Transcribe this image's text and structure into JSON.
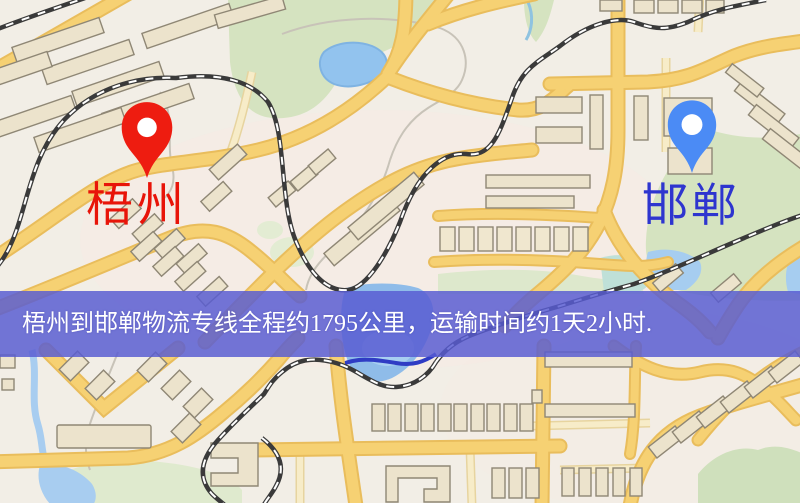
{
  "map": {
    "markers": {
      "origin": {
        "label": "梧州",
        "pin_color": "#ee1c10",
        "label_color": "#e81409"
      },
      "destination": {
        "label": "邯郸",
        "pin_color": "#4b8bf5",
        "label_color": "#2e35cf"
      }
    },
    "banner": {
      "text": "梧州到邯郸物流专线全程约1795公里，运输时间约1天2小时.",
      "background_color": "#585cd2",
      "text_color": "#ffffff"
    },
    "palette": {
      "background": "#f2eee6",
      "road": "#f6d173",
      "road_casing": "#e9bd5c",
      "road_minor": "#f7ecc8",
      "water": "#9cc7ee",
      "green": "#d5e3c0",
      "building": "#ece3cc",
      "railway": "#3a3a3a"
    }
  }
}
